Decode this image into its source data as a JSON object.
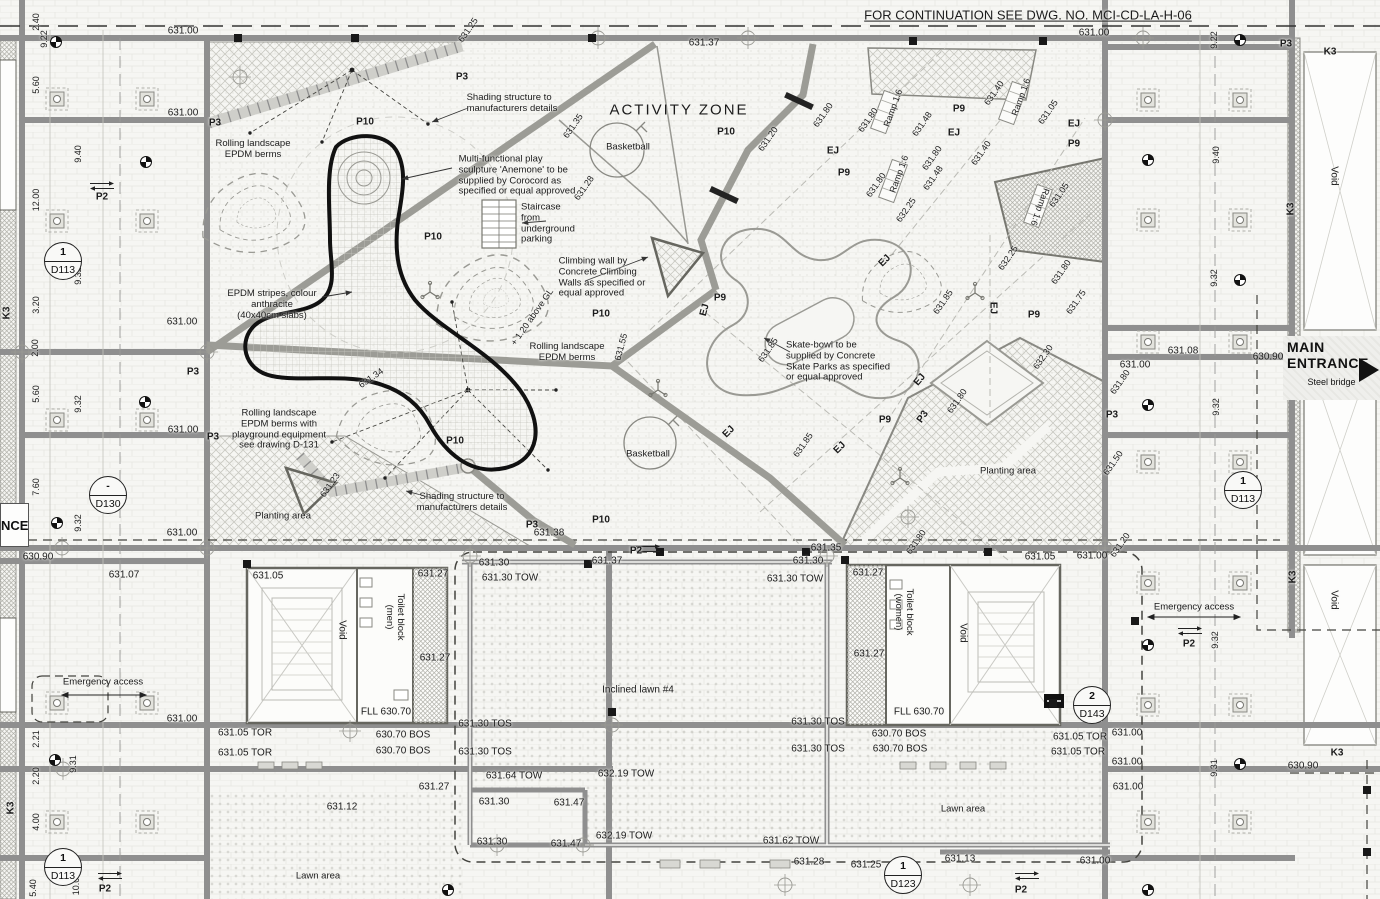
{
  "drawing": {
    "continuation_note": "FOR CONTINUATION SEE DWG. NO. MCI-CD-LA-H-06",
    "zone_title": "ACTIVITY ZONE",
    "main_ent_line1": "MAIN",
    "main_ent_line2": "ENTRANCE",
    "steel_bridge": "Steel bridge",
    "entrance_clip": "NCE"
  },
  "colors": {
    "paper": "#f6f6f3",
    "beam": "#8f8f8f",
    "text": "#1b1b1b",
    "hatch": "#c9c9c2",
    "black_feature": "#111111"
  },
  "callouts": [
    {
      "n": "1",
      "c": "D113",
      "x": 63,
      "y": 261
    },
    {
      "n": "-",
      "c": "D130",
      "x": 108,
      "y": 495
    },
    {
      "n": "1",
      "c": "D113",
      "x": 1243,
      "y": 490
    },
    {
      "n": "2",
      "c": "D143",
      "x": 1092,
      "y": 705
    },
    {
      "n": "1",
      "c": "D113",
      "x": 63,
      "y": 867
    },
    {
      "n": "1",
      "c": "D123",
      "x": 903,
      "y": 875
    }
  ],
  "labels": [
    {
      "t": "FOR CONTINUATION SEE DWG. NO. MCI-CD-LA-H-06",
      "x": 1028,
      "y": 16,
      "fs": 13,
      "u": 1
    },
    {
      "t": "ACTIVITY ZONE",
      "x": 679,
      "y": 110,
      "fs": 15,
      "ls": 2
    },
    {
      "t": "631.00",
      "x": 183,
      "y": 31
    },
    {
      "t": "631.37",
      "x": 704,
      "y": 43
    },
    {
      "t": "631.00",
      "x": 1094,
      "y": 33
    },
    {
      "t": "631.25",
      "x": 468,
      "y": 30,
      "r": -55,
      "fs": 9
    },
    {
      "t": "P3",
      "x": 462,
      "y": 77,
      "b": 1
    },
    {
      "t": "P3",
      "x": 215,
      "y": 123,
      "b": 1
    },
    {
      "t": "P3",
      "x": 1286,
      "y": 44,
      "b": 1
    },
    {
      "t": "K3",
      "x": 1330,
      "y": 52,
      "b": 1
    },
    {
      "t": "2.40",
      "x": 36,
      "y": 22,
      "r": -90,
      "fs": 9
    },
    {
      "t": "9.22",
      "x": 44,
      "y": 39,
      "r": -90,
      "fs": 9
    },
    {
      "t": "5.60",
      "x": 36,
      "y": 85,
      "r": -90,
      "fs": 9
    },
    {
      "t": "9.40",
      "x": 78,
      "y": 154,
      "r": -90,
      "fs": 9
    },
    {
      "t": "12.00",
      "x": 36,
      "y": 200,
      "r": -90,
      "fs": 9
    },
    {
      "t": "9.32",
      "x": 78,
      "y": 276,
      "r": -90,
      "fs": 9
    },
    {
      "t": "3.20",
      "x": 36,
      "y": 305,
      "r": -90,
      "fs": 9
    },
    {
      "t": "2.00",
      "x": 35,
      "y": 348,
      "r": -90,
      "fs": 9
    },
    {
      "t": "5.60",
      "x": 36,
      "y": 394,
      "r": -90,
      "fs": 9
    },
    {
      "t": "9.32",
      "x": 78,
      "y": 404,
      "r": -90,
      "fs": 9
    },
    {
      "t": "7.60",
      "x": 36,
      "y": 487,
      "r": -90,
      "fs": 9
    },
    {
      "t": "9.32",
      "x": 78,
      "y": 523,
      "r": -90,
      "fs": 9
    },
    {
      "t": "2.21",
      "x": 36,
      "y": 739,
      "r": -90,
      "fs": 9
    },
    {
      "t": "9.31",
      "x": 73,
      "y": 764,
      "r": -90,
      "fs": 9
    },
    {
      "t": "2.20",
      "x": 36,
      "y": 776,
      "r": -90,
      "fs": 9
    },
    {
      "t": "4.00",
      "x": 36,
      "y": 822,
      "r": -90,
      "fs": 9
    },
    {
      "t": "5.40",
      "x": 33,
      "y": 888,
      "r": -90,
      "fs": 9
    },
    {
      "t": "10.00",
      "x": 76,
      "y": 884,
      "r": -90,
      "fs": 9
    },
    {
      "t": "K3",
      "x": 7,
      "y": 313,
      "r": -90,
      "b": 1
    },
    {
      "t": "K3",
      "x": 11,
      "y": 808,
      "r": -90,
      "b": 1
    },
    {
      "t": "631.00",
      "x": 183,
      "y": 113
    },
    {
      "t": "631.00",
      "x": 182,
      "y": 322
    },
    {
      "t": "631.00",
      "x": 183,
      "y": 430
    },
    {
      "t": "631.00",
      "x": 182,
      "y": 533
    },
    {
      "t": "631.00",
      "x": 182,
      "y": 719
    },
    {
      "t": "630.90",
      "x": 38,
      "y": 557
    },
    {
      "t": "631.07",
      "x": 124,
      "y": 575
    },
    {
      "t": "P2",
      "x": 102,
      "y": 197,
      "b": 1
    },
    {
      "t": "P3",
      "x": 193,
      "y": 372,
      "b": 1
    },
    {
      "t": "P3",
      "x": 213,
      "y": 437,
      "b": 1
    },
    {
      "t": "Emergency access",
      "x": 103,
      "y": 683,
      "fs": 9.5
    },
    {
      "t": "P2",
      "x": 105,
      "y": 889,
      "b": 1
    },
    {
      "t": "Lawn area",
      "x": 318,
      "y": 877,
      "fs": 9.5
    },
    {
      "t": "631.05",
      "x": 268,
      "y": 576
    },
    {
      "t": "631.27",
      "x": 433,
      "y": 574
    },
    {
      "t": "631.27",
      "x": 435,
      "y": 658
    },
    {
      "t": "Void",
      "x": 342,
      "y": 630,
      "r": 90
    },
    {
      "t": "Toilet block\n(men)",
      "x": 394,
      "y": 617,
      "r": 90,
      "fs": 9.5
    },
    {
      "t": "FLL 630.70",
      "x": 386,
      "y": 712
    },
    {
      "t": "631.05 TOR",
      "x": 245,
      "y": 733
    },
    {
      "t": "631.05 TOR",
      "x": 245,
      "y": 753
    },
    {
      "t": "630.70 BOS",
      "x": 403,
      "y": 735
    },
    {
      "t": "630.70 BOS",
      "x": 403,
      "y": 751
    },
    {
      "t": "631.12",
      "x": 342,
      "y": 807
    },
    {
      "t": "631.27",
      "x": 434,
      "y": 787
    },
    {
      "t": "P2",
      "x": 636,
      "y": 551,
      "b": 1
    },
    {
      "t": "631.30",
      "x": 494,
      "y": 563
    },
    {
      "t": "631.37",
      "x": 607,
      "y": 561
    },
    {
      "t": "631.30",
      "x": 808,
      "y": 561
    },
    {
      "t": "631.35",
      "x": 826,
      "y": 548
    },
    {
      "t": "631.30 TOW",
      "x": 510,
      "y": 578
    },
    {
      "t": "631.30 TOW",
      "x": 795,
      "y": 579
    },
    {
      "t": "Inclined lawn #4",
      "x": 638,
      "y": 690
    },
    {
      "t": "631.30 TOS",
      "x": 485,
      "y": 724
    },
    {
      "t": "631.30 TOS",
      "x": 818,
      "y": 722
    },
    {
      "t": "631.30 TOS",
      "x": 485,
      "y": 752
    },
    {
      "t": "631.30 TOS",
      "x": 818,
      "y": 749
    },
    {
      "t": "631.64 TOW",
      "x": 514,
      "y": 776
    },
    {
      "t": "632.19 TOW",
      "x": 626,
      "y": 774
    },
    {
      "t": "631.30",
      "x": 494,
      "y": 802
    },
    {
      "t": "631.47",
      "x": 569,
      "y": 803
    },
    {
      "t": "631.30",
      "x": 492,
      "y": 842
    },
    {
      "t": "631.47",
      "x": 566,
      "y": 844
    },
    {
      "t": "632.19 TOW",
      "x": 624,
      "y": 836
    },
    {
      "t": "631.62 TOW",
      "x": 791,
      "y": 841
    },
    {
      "t": "631.28",
      "x": 809,
      "y": 862
    },
    {
      "t": "631.25",
      "x": 866,
      "y": 865
    },
    {
      "t": "631.13",
      "x": 960,
      "y": 859
    },
    {
      "t": "631.00",
      "x": 1095,
      "y": 861
    },
    {
      "t": "Lawn area",
      "x": 963,
      "y": 810,
      "fs": 9.5
    },
    {
      "t": "631.27",
      "x": 868,
      "y": 573
    },
    {
      "t": "631.27",
      "x": 869,
      "y": 654
    },
    {
      "t": "Toilet block\n(women)",
      "x": 903,
      "y": 612,
      "r": 90,
      "fs": 9.5
    },
    {
      "t": "Void",
      "x": 963,
      "y": 633,
      "r": 90
    },
    {
      "t": "FLL 630.70",
      "x": 919,
      "y": 712
    },
    {
      "t": "630.70 BOS",
      "x": 899,
      "y": 734
    },
    {
      "t": "630.70 BOS",
      "x": 900,
      "y": 749
    },
    {
      "t": "631.05 TOR",
      "x": 1080,
      "y": 737
    },
    {
      "t": "631.05 TOR",
      "x": 1078,
      "y": 752
    },
    {
      "t": "631.05",
      "x": 1040,
      "y": 557
    },
    {
      "t": "631.00",
      "x": 1092,
      "y": 556
    },
    {
      "t": "631.20",
      "x": 1120,
      "y": 545,
      "r": -55,
      "fs": 9
    },
    {
      "t": "Emergency access",
      "x": 1194,
      "y": 608,
      "fs": 9.5
    },
    {
      "t": "P2",
      "x": 1189,
      "y": 644,
      "b": 1
    },
    {
      "t": "9.32",
      "x": 1215,
      "y": 640,
      "r": -90,
      "fs": 9
    },
    {
      "t": "631.00",
      "x": 1127,
      "y": 733
    },
    {
      "t": "631.00",
      "x": 1127,
      "y": 762
    },
    {
      "t": "9.31",
      "x": 1214,
      "y": 768,
      "r": -90,
      "fs": 9
    },
    {
      "t": "630.90",
      "x": 1303,
      "y": 766
    },
    {
      "t": "K3",
      "x": 1293,
      "y": 577,
      "r": -90,
      "b": 1
    },
    {
      "t": "K3",
      "x": 1337,
      "y": 753,
      "b": 1
    },
    {
      "t": "Void",
      "x": 1334,
      "y": 600,
      "r": 90
    },
    {
      "t": "631.00",
      "x": 1135,
      "y": 365
    },
    {
      "t": "631.08",
      "x": 1183,
      "y": 351
    },
    {
      "t": "630.90",
      "x": 1268,
      "y": 357
    },
    {
      "t": "9.32",
      "x": 1216,
      "y": 407,
      "r": -90,
      "fs": 9
    },
    {
      "t": "9.32",
      "x": 1214,
      "y": 278,
      "r": -90,
      "fs": 9
    },
    {
      "t": "9.40",
      "x": 1216,
      "y": 155,
      "r": -90,
      "fs": 9
    },
    {
      "t": "9.22",
      "x": 1214,
      "y": 40,
      "r": -90,
      "fs": 9
    },
    {
      "t": "Void",
      "x": 1334,
      "y": 176,
      "r": 90
    },
    {
      "t": "K3",
      "x": 1291,
      "y": 209,
      "r": -90,
      "b": 1
    },
    {
      "t": "631.00",
      "x": 1128,
      "y": 787
    },
    {
      "t": "P2",
      "x": 1021,
      "y": 890,
      "b": 1
    },
    {
      "t": "Basketball",
      "x": 628,
      "y": 148,
      "fs": 9.5
    },
    {
      "t": "Basketball",
      "x": 648,
      "y": 455,
      "fs": 9.5
    },
    {
      "t": "P10",
      "x": 365,
      "y": 122,
      "b": 1
    },
    {
      "t": "P10",
      "x": 726,
      "y": 132,
      "b": 1
    },
    {
      "t": "P10",
      "x": 433,
      "y": 237,
      "b": 1
    },
    {
      "t": "P10",
      "x": 601,
      "y": 314,
      "b": 1
    },
    {
      "t": "P10",
      "x": 455,
      "y": 441,
      "b": 1
    },
    {
      "t": "P10",
      "x": 601,
      "y": 520,
      "b": 1
    },
    {
      "t": "P9",
      "x": 959,
      "y": 109,
      "b": 1
    },
    {
      "t": "P9",
      "x": 844,
      "y": 173,
      "b": 1
    },
    {
      "t": "P9",
      "x": 1074,
      "y": 144,
      "b": 1
    },
    {
      "t": "P9",
      "x": 720,
      "y": 298,
      "b": 1
    },
    {
      "t": "P9",
      "x": 1034,
      "y": 315,
      "b": 1
    },
    {
      "t": "P9",
      "x": 885,
      "y": 420,
      "b": 1
    },
    {
      "t": "Rolling landscape\nEPDM berms",
      "x": 253,
      "y": 150,
      "fs": 9.5
    },
    {
      "t": "Multi-functional play\nsculpture 'Anemone' to be\nsupplied by Corocord as\nspecified or equal approved",
      "x": 517,
      "y": 176,
      "fs": 9.5,
      "ta": "left"
    },
    {
      "t": "Shading structure to\nmanufacturers details",
      "x": 512,
      "y": 104,
      "fs": 9.5,
      "ta": "left"
    },
    {
      "t": "Staircase\nfrom\nunderground\nparking",
      "x": 548,
      "y": 224,
      "fs": 9.5,
      "ta": "left"
    },
    {
      "t": "Climbing wall by\nConcrete Climbing\nWalls as specified or\nequal approved",
      "x": 602,
      "y": 278,
      "fs": 9.5,
      "ta": "left"
    },
    {
      "t": "EPDM stripes, colour\nanthracite\n(40x40cm slabs)",
      "x": 272,
      "y": 305,
      "fs": 9.5
    },
    {
      "t": "Rolling landscape\nEPDM berms",
      "x": 567,
      "y": 353,
      "fs": 9.5
    },
    {
      "t": "Rolling landscape\nEPDM berms with\nplayground equipment\nsee drawing D-131",
      "x": 279,
      "y": 430,
      "fs": 9.5
    },
    {
      "t": "Planting area",
      "x": 283,
      "y": 517,
      "fs": 9.5
    },
    {
      "t": "Shading structure to\nmanufacturers details",
      "x": 462,
      "y": 503,
      "fs": 9.5
    },
    {
      "t": "Skate-bowl to be\nsupplied by Concrete\nSkate Parks as specified\nor equal approved",
      "x": 838,
      "y": 362,
      "fs": 9.5,
      "ta": "left"
    },
    {
      "t": "Planting area",
      "x": 1008,
      "y": 472,
      "fs": 9.5
    },
    {
      "t": "+ 1.20 above GL",
      "x": 532,
      "y": 317,
      "r": -55,
      "fs": 9
    },
    {
      "t": "631.55",
      "x": 621,
      "y": 347,
      "r": -75,
      "fs": 9
    },
    {
      "t": "631.34",
      "x": 371,
      "y": 378,
      "r": -35,
      "fs": 9
    },
    {
      "t": "631.23",
      "x": 330,
      "y": 485,
      "r": -55,
      "fs": 9
    },
    {
      "t": "P3",
      "x": 532,
      "y": 525,
      "b": 1
    },
    {
      "t": "631.38",
      "x": 549,
      "y": 533
    },
    {
      "t": "631.35",
      "x": 573,
      "y": 126,
      "r": -55,
      "fs": 9
    },
    {
      "t": "631.28",
      "x": 584,
      "y": 188,
      "r": -55,
      "fs": 9
    },
    {
      "t": "631.20",
      "x": 768,
      "y": 139,
      "r": -55,
      "fs": 9
    },
    {
      "t": "631.80",
      "x": 823,
      "y": 115,
      "r": -55,
      "fs": 9
    },
    {
      "t": "631.80",
      "x": 868,
      "y": 120,
      "r": -55,
      "fs": 9
    },
    {
      "t": "631.48",
      "x": 922,
      "y": 124,
      "r": -55,
      "fs": 9
    },
    {
      "t": "631.40",
      "x": 994,
      "y": 93,
      "r": -55,
      "fs": 9
    },
    {
      "t": "631.05",
      "x": 1048,
      "y": 112,
      "r": -55,
      "fs": 9
    },
    {
      "t": "631.40",
      "x": 981,
      "y": 153,
      "r": -55,
      "fs": 9
    },
    {
      "t": "631.80",
      "x": 932,
      "y": 158,
      "r": -55,
      "fs": 9
    },
    {
      "t": "631.48",
      "x": 933,
      "y": 178,
      "r": -55,
      "fs": 9
    },
    {
      "t": "631.80",
      "x": 876,
      "y": 185,
      "r": -55,
      "fs": 9
    },
    {
      "t": "632.25",
      "x": 906,
      "y": 210,
      "r": -55,
      "fs": 9
    },
    {
      "t": "631.05",
      "x": 1059,
      "y": 195,
      "r": -55,
      "fs": 9
    },
    {
      "t": "631.85",
      "x": 943,
      "y": 302,
      "r": -55,
      "fs": 9
    },
    {
      "t": "632.25",
      "x": 1008,
      "y": 258,
      "r": -55,
      "fs": 9
    },
    {
      "t": "631.80",
      "x": 1061,
      "y": 272,
      "r": -55,
      "fs": 9
    },
    {
      "t": "631.75",
      "x": 1076,
      "y": 302,
      "r": -55,
      "fs": 9
    },
    {
      "t": "631.85",
      "x": 768,
      "y": 350,
      "r": -55,
      "fs": 9
    },
    {
      "t": "632.30",
      "x": 1043,
      "y": 357,
      "r": -55,
      "fs": 9
    },
    {
      "t": "631.80",
      "x": 957,
      "y": 401,
      "r": -55,
      "fs": 9
    },
    {
      "t": "631.85",
      "x": 803,
      "y": 445,
      "r": -55,
      "fs": 9
    },
    {
      "t": "631.80",
      "x": 1120,
      "y": 382,
      "r": -55,
      "fs": 9
    },
    {
      "t": "631.50",
      "x": 1113,
      "y": 463,
      "r": -55,
      "fs": 9
    },
    {
      "t": "631.80",
      "x": 916,
      "y": 542,
      "r": -55,
      "fs": 9
    },
    {
      "t": "P3",
      "x": 923,
      "y": 417,
      "r": -55,
      "b": 1
    },
    {
      "t": "P3",
      "x": 1112,
      "y": 415,
      "b": 1
    },
    {
      "t": "Ramp 1:6",
      "x": 893,
      "y": 108,
      "r": -70,
      "fs": 9
    },
    {
      "t": "Ramp 1:6",
      "x": 1021,
      "y": 97,
      "r": -70,
      "fs": 9
    },
    {
      "t": "Ramp 1:6",
      "x": 899,
      "y": 174,
      "r": -70,
      "fs": 9
    },
    {
      "t": "Ramp 1:6",
      "x": 1040,
      "y": 207,
      "r": 110,
      "fs": 9
    },
    {
      "t": "EJ",
      "x": 833,
      "y": 151,
      "b": 1
    },
    {
      "t": "EJ",
      "x": 954,
      "y": 133,
      "b": 1
    },
    {
      "t": "EJ",
      "x": 1074,
      "y": 124,
      "b": 1
    },
    {
      "t": "EJ",
      "x": 885,
      "y": 261,
      "r": -45,
      "b": 1
    },
    {
      "t": "EJ",
      "x": 993,
      "y": 308,
      "r": 90,
      "b": 1
    },
    {
      "t": "EJ",
      "x": 920,
      "y": 380,
      "r": -50,
      "b": 1
    },
    {
      "t": "EJ",
      "x": 729,
      "y": 432,
      "r": -45,
      "b": 1
    },
    {
      "t": "EJ",
      "x": 840,
      "y": 448,
      "r": -45,
      "b": 1
    },
    {
      "t": "EJ",
      "x": 705,
      "y": 310,
      "r": -75,
      "b": 1
    }
  ]
}
